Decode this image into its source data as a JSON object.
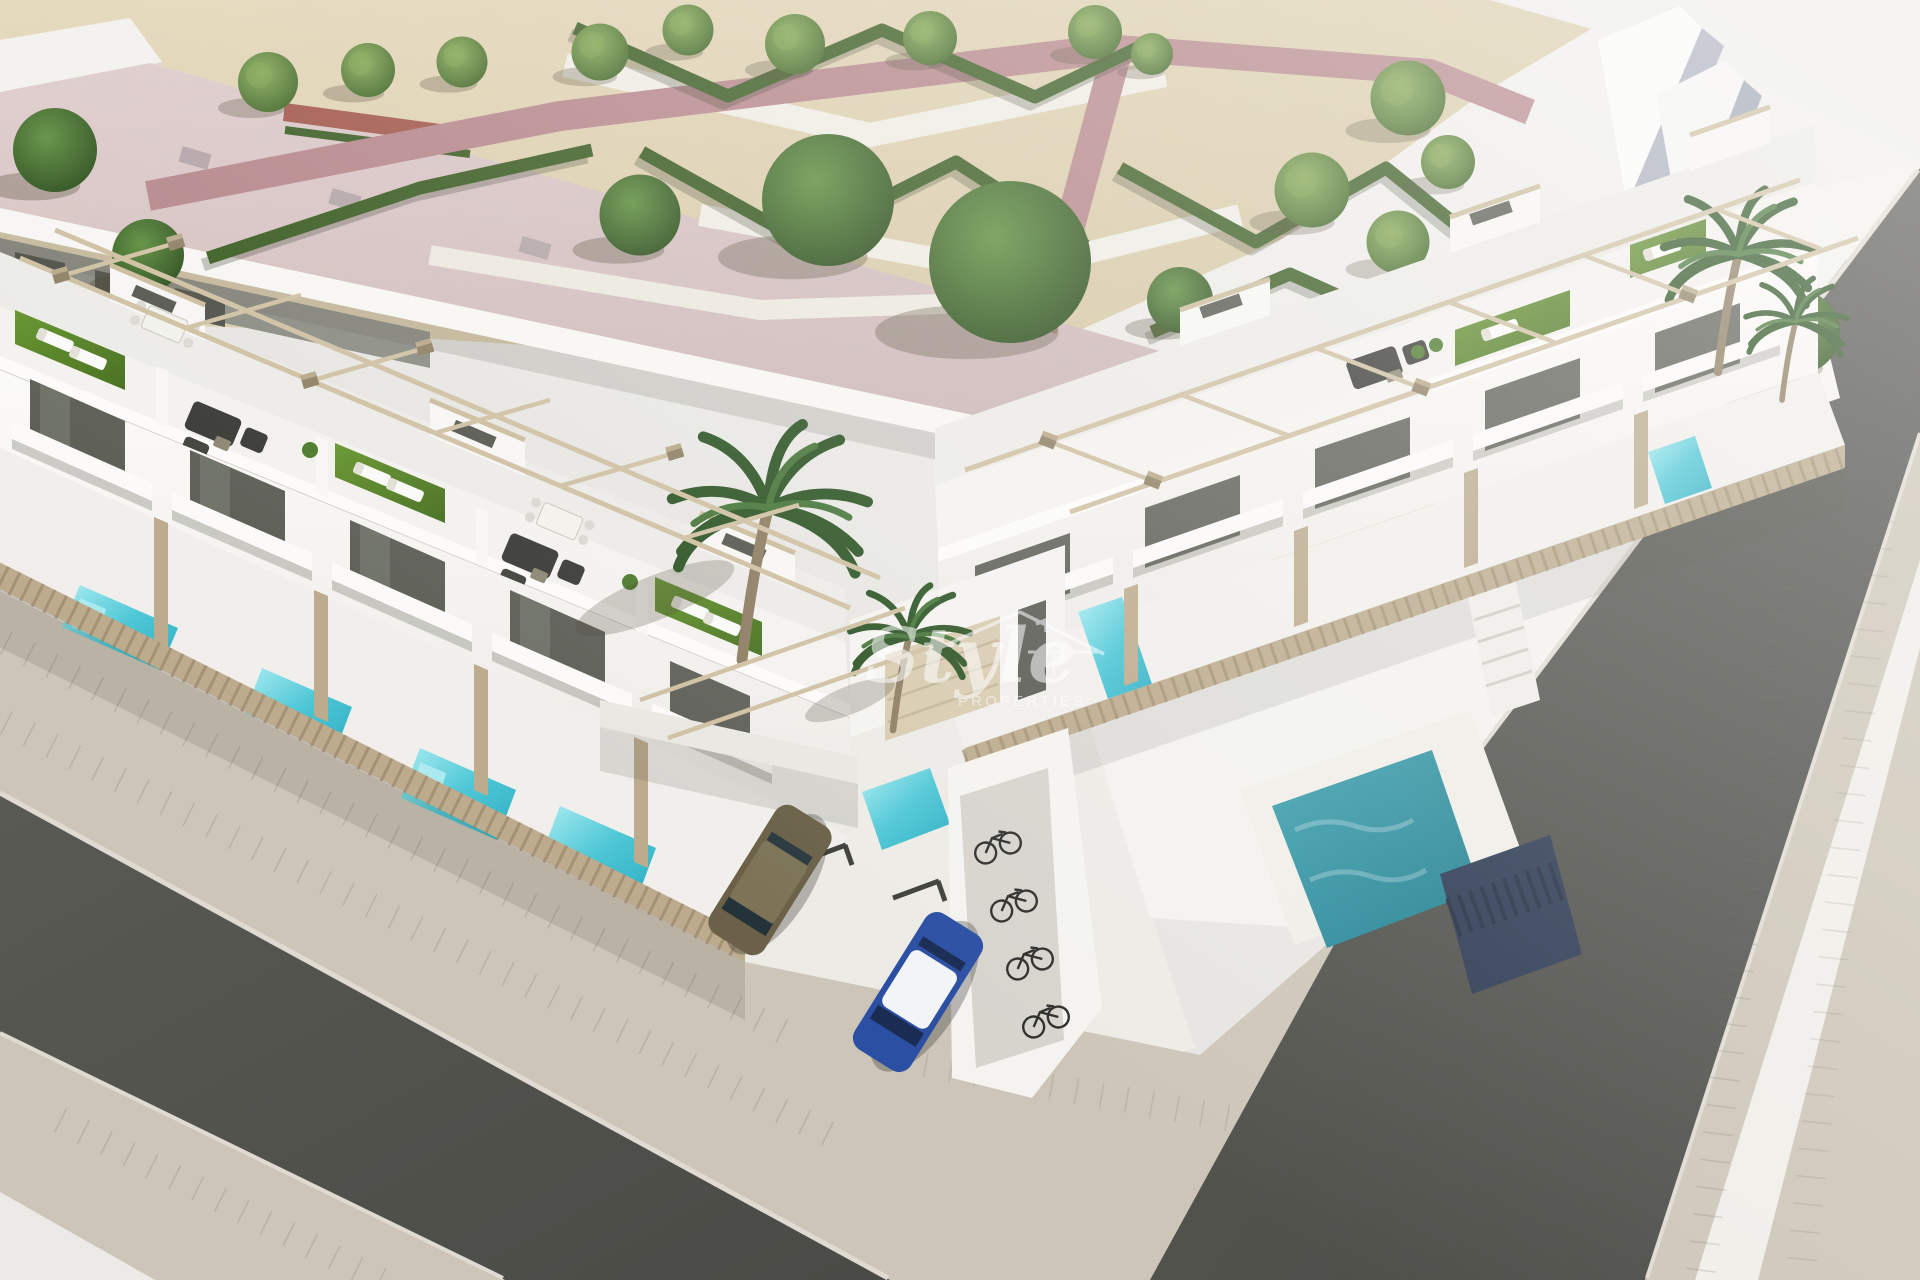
{
  "image": {
    "type": "3d-architectural-render",
    "subject": "Aerial 3D render of a modern white townhouse development on a street corner with rooftop terraces, private pools, landscaped park and surrounding streets",
    "width_px": 1920,
    "height_px": 1280
  },
  "watermark": {
    "brand": "Style",
    "brand_sub": "PROPERTIES",
    "logo": "house-roof-outline",
    "opacity": 0.55
  },
  "palette": {
    "background": "#e9e7e3",
    "sand": "#dccfae",
    "path_pink": "#b5868a",
    "path_white": "#efece4",
    "hedge": "#3a5c22",
    "tree": "#4e7c2e",
    "turf": "#578a28",
    "roof_pink": "#d5c2c1",
    "wall_white": "#f5f4f1",
    "wall_shade": "#ecebe7",
    "glass": "#5f6159",
    "wood": "#bcab8d",
    "pergola": "#cfc0a2",
    "asphalt": "#53534e",
    "paver": "#cdc6b8",
    "curb": "#dfdbd2",
    "pool": "#45c4d4",
    "pool_deep": "#2d93a2",
    "sofa": "#3b3b37",
    "car_olive": "#6a6148",
    "car_blue": "#2b4fa3",
    "car_black": "#191a1d",
    "watermark": "#ffffff"
  },
  "scene": {
    "counts": {
      "townhouse_units_left_row": 5,
      "townhouse_units_right_row": 5,
      "private_pools": 7,
      "cars": 3,
      "bicycles": 4,
      "palm_trees": 4,
      "park_trees": 20
    },
    "features": [
      "rooftop terraces with artificial turf and sun loungers",
      "dark rattan sofa sets and dining sets on roofs",
      "beige pergola frames",
      "turquoise private plunge pools",
      "wood slat privacy fences",
      "landscaped park with zigzag hedges and pink walkways",
      "corner plot with two asphalt streets and paver sidewalks",
      "driveway parking with marked bays",
      "bicycle shelter",
      "large existing building with pink flat roof"
    ]
  }
}
